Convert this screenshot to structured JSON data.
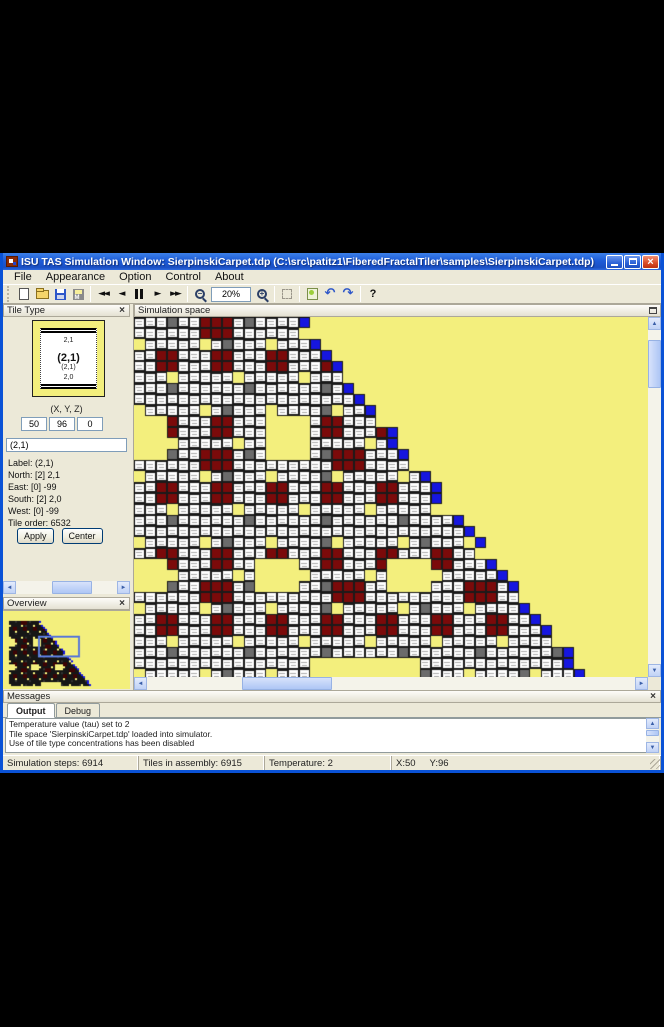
{
  "glyphs": {
    "close": "×",
    "left": "◄",
    "right": "►",
    "up": "▲",
    "down": "▼",
    "rewind": "◄◄",
    "stepback": "◄",
    "play": "►",
    "ffwd": "►►",
    "minus": "−",
    "plus": "+",
    "undo": "↶",
    "redo": "↷",
    "help": "?"
  },
  "window": {
    "title": "ISU TAS Simulation Window: SierpinskiCarpet.tdp (C:\\src\\patitz1\\FiberedFractalTiler\\samples\\SierpinskiCarpet.tdp)"
  },
  "menu": {
    "items": [
      "File",
      "Appearance",
      "Option",
      "Control",
      "About"
    ]
  },
  "toolbar": {
    "zoom_value": "20%"
  },
  "panels": {
    "tile_type": {
      "title": "Tile Type",
      "preview": {
        "north": "2,1",
        "center": "(2,1)",
        "sub": "(2,1)",
        "south": "2,0"
      },
      "coords_label": "(X, Y, Z)",
      "x_value": "50",
      "y_value": "96",
      "z_value": "0",
      "name_value": "(2,1)",
      "info": [
        "Label: (2,1)",
        "North: [2] 2,1",
        "East:   [0] -99",
        "South: [2] 2,0",
        "West: [0] -99",
        "Tile order: 6532"
      ],
      "apply_label": "Apply",
      "center_label": "Center"
    },
    "overview": {
      "title": "Overview"
    },
    "simulation": {
      "title": "Simulation space"
    },
    "messages": {
      "title": "Messages",
      "tabs": [
        "Output",
        "Debug"
      ],
      "lines": [
        "Temperature value (tau) set to 2",
        "Tile space 'SierpinskiCarpet.tdp' loaded into simulator.",
        "Use of tile type concentrations has been disabled"
      ]
    }
  },
  "status": {
    "steps": "Simulation steps: 6914",
    "tiles": "Tiles in assembly: 6915",
    "temperature": "Temperature: 2",
    "x": "X:50",
    "y": "Y:96"
  },
  "sim_grid": {
    "tile": 11,
    "cols": 47,
    "rows": 33,
    "edge_base": 15,
    "edge_slope": 0.8,
    "colors": {
      "bg": "#F3EF7D",
      "white": "#FFFFFF",
      "maroon": "#7B0A0A",
      "gray": "#6B6B6B",
      "blue": "#1616DF",
      "border": "#1A1A1A",
      "speck": "#ABABAB"
    },
    "big_holes": [
      {
        "c": 0,
        "r": 9,
        "w": 3,
        "h": 4
      },
      {
        "c": 12,
        "r": 9,
        "w": 4,
        "h": 4
      },
      {
        "c": 0,
        "r": 22,
        "w": 3,
        "h": 3
      },
      {
        "c": 11,
        "r": 22,
        "w": 4,
        "h": 3
      },
      {
        "c": 23,
        "r": 22,
        "w": 4,
        "h": 3
      },
      {
        "c": 16,
        "r": 31,
        "w": 10,
        "h": 2
      }
    ],
    "overview": {
      "cell": 2,
      "ox": 6,
      "oy": 10,
      "viewport": {
        "x": 36,
        "y": 26,
        "w": 40,
        "h": 20
      },
      "viewport_color": "#5B79D6",
      "shape_colors": {
        "white": "#161616",
        "maroon": "#3d0404",
        "gray": "#303030",
        "blue": "#1616DF"
      }
    }
  }
}
